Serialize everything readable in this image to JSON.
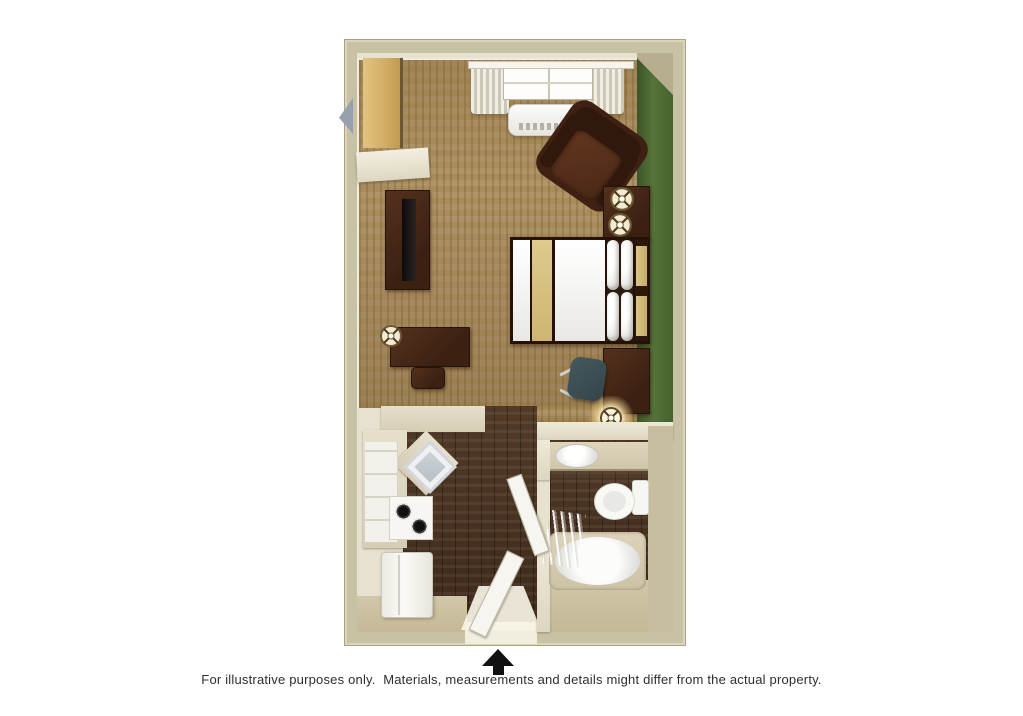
{
  "caption": {
    "text": "For illustrative purposes only.  Materials, measurements and details might differ from the actual property."
  },
  "marker": {
    "entrance_arrow": "up-arrow"
  },
  "palette": {
    "wall_outer": "#c8c2a5",
    "wall_inner": "#e7e1d0",
    "carpet": "#a0854f",
    "accent_wall_green": "#4c6a36",
    "wood_floor": "#4a3424",
    "furniture_dark_wood": "#47291a",
    "counter": "#ddd6c2",
    "bedding_khaki": "#d6c286",
    "appliance_white": "#f4f3f0",
    "chair_teal": "#3c5054",
    "arrow_black": "#111111"
  },
  "objects": [
    "closet",
    "shelf",
    "tv-console",
    "tv",
    "desk",
    "table-lamp",
    "ottoman",
    "window",
    "curtains",
    "ac-unit",
    "armchair",
    "nightstand",
    "bed",
    "pillows",
    "headboard",
    "work-desk",
    "office-chair",
    "kitchen-counter",
    "kitchen-sink",
    "stove",
    "cabinet-drawers",
    "refrigerator",
    "entry-door",
    "bathroom-door",
    "vanity-sink",
    "toilet",
    "bathtub",
    "shower-curtain"
  ]
}
